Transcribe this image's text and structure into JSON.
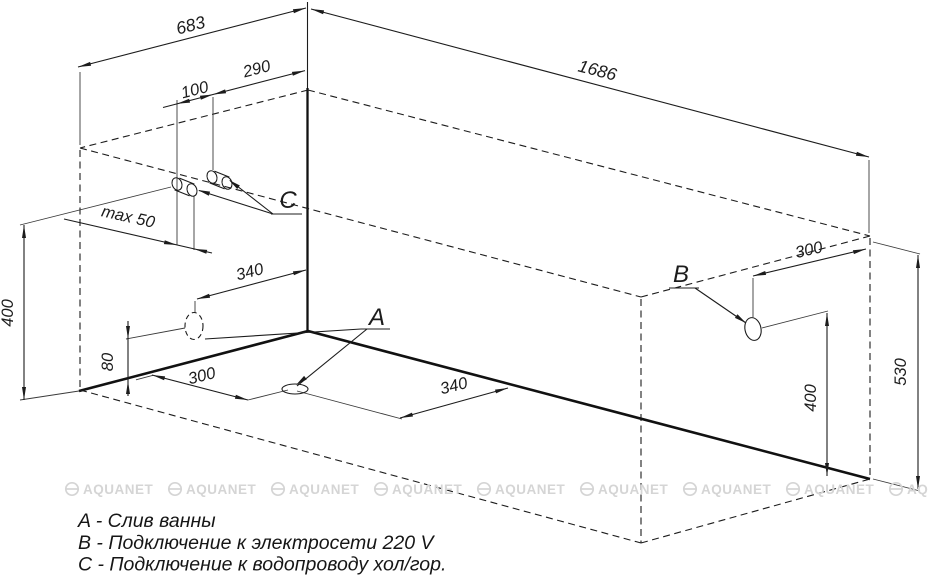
{
  "dims": {
    "top_width": "683",
    "top_length": "1686",
    "c_from_corner": "290",
    "c_pair_gap": "100",
    "c_max_depth": "max 50",
    "wall_drain_from_corner": "340",
    "pipes_height": "400",
    "wall_drain_height": "80",
    "floor_drain_side": "300",
    "floor_drain_front": "340",
    "b_from_edge": "300",
    "b_height": "400",
    "overall_height": "530"
  },
  "point_labels": {
    "drain": "A",
    "power": "B",
    "water": "C"
  },
  "legend": {
    "items": [
      {
        "text": "A - Слив ванны"
      },
      {
        "text": "B - Подключение к электросети 220 V"
      },
      {
        "text": "C - Подключение к водопроводу хол/гор."
      }
    ]
  },
  "watermark": {
    "text": "AQUANET"
  }
}
